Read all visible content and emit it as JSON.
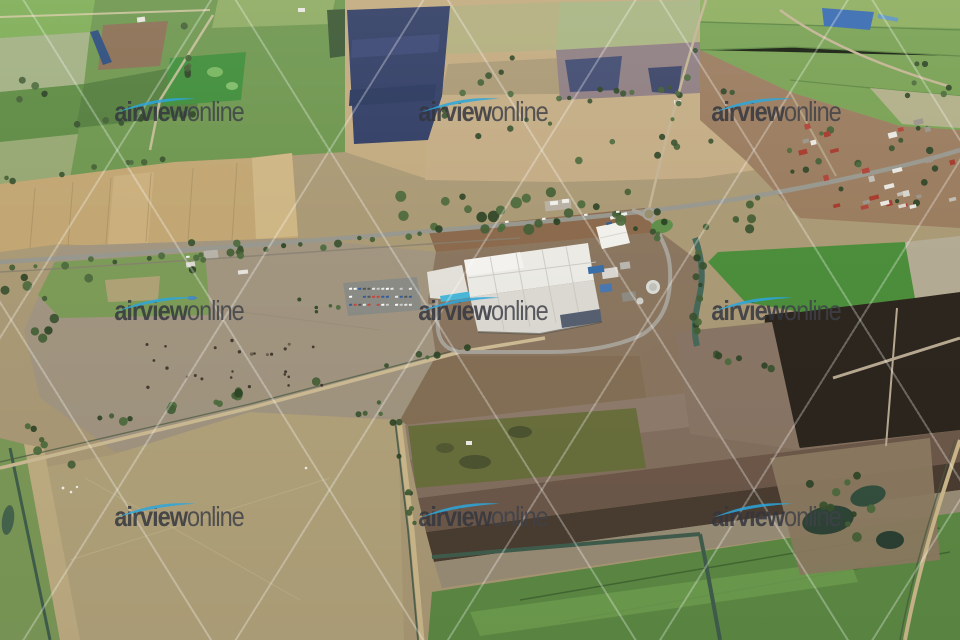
{
  "photo": {
    "type": "oblique aerial photograph",
    "scene": "rural irrigation farmland with a highway, small town and a large white factory complex",
    "width_px": 960,
    "height_px": 640
  },
  "watermark": {
    "brand_bold": "airview",
    "brand_light": "online",
    "count": 9,
    "swoosh_color": "#2ba7de",
    "text_color": "#34363f",
    "diagonal_line_color": "rgba(255,255,255,0.34)"
  },
  "palette": {
    "field_green": "#6f9750",
    "field_wheat": "#c2a774",
    "field_navy": "#333f66",
    "plowed_dark": "#4b3d31",
    "burnt_black": "#2d261e",
    "factory_roof": "#e9e8e2",
    "water_channel": "#47695a",
    "highway_gray": "#98988f",
    "dirt_road_tan": "#cdbc94",
    "town_dirt": "#9b7d60"
  }
}
